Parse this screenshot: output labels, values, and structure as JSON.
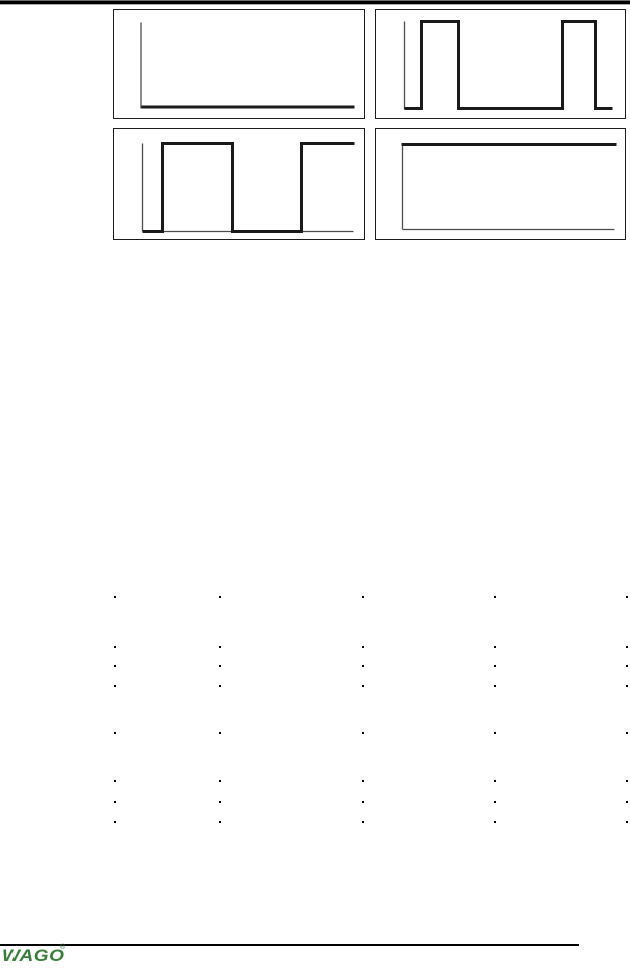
{
  "style": {
    "background": "#ffffff",
    "rule_color": "#000000",
    "box_border_color": "#1c1c1c",
    "axis_color": "#4d4d4d",
    "axis_width": 1.3,
    "signal_color": "#1a1a1a",
    "signal_width": 3,
    "logo_color": "#377e36",
    "dot_color": "#000000"
  },
  "figures": [
    {
      "name": "signal-constant-low",
      "x": 113,
      "y": 9,
      "w": 252,
      "h": 110,
      "axes": [
        {
          "x1": 28.5,
          "y1": 14,
          "x2": 28.5,
          "y2": 100
        }
      ],
      "signal": [
        [
          29,
          98.5
        ],
        [
          242,
          98.5
        ]
      ]
    },
    {
      "name": "pulse-train",
      "x": 375,
      "y": 9,
      "w": 251,
      "h": 110,
      "axes": [
        {
          "x1": 30,
          "y1": 13,
          "x2": 30,
          "y2": 101
        }
      ],
      "signal": [
        [
          30,
          100
        ],
        [
          47,
          100
        ],
        [
          47,
          13
        ],
        [
          84,
          13
        ],
        [
          84,
          100
        ],
        [
          188,
          100
        ],
        [
          188,
          13
        ],
        [
          221,
          13
        ],
        [
          221,
          100
        ],
        [
          238,
          100
        ]
      ]
    },
    {
      "name": "square-wave",
      "x": 113,
      "y": 128,
      "w": 252,
      "h": 112,
      "axes": [
        {
          "x1": 30,
          "y1": 16,
          "x2": 30,
          "y2": 104
        },
        {
          "x1": 30,
          "y1": 104,
          "x2": 241,
          "y2": 104
        }
      ],
      "signal": [
        [
          30,
          104
        ],
        [
          50,
          104
        ],
        [
          50,
          16
        ],
        [
          120,
          16
        ],
        [
          120,
          104
        ],
        [
          189,
          104
        ],
        [
          189,
          16
        ],
        [
          242,
          16
        ]
      ]
    },
    {
      "name": "signal-constant-high",
      "x": 375,
      "y": 128,
      "w": 251,
      "h": 112,
      "axes": [
        {
          "x1": 28,
          "y1": 16,
          "x2": 28,
          "y2": 102
        },
        {
          "x1": 28,
          "y1": 102,
          "x2": 240,
          "y2": 102
        }
      ],
      "signal": [
        [
          27,
          17
        ],
        [
          242,
          17
        ]
      ]
    }
  ],
  "dot_grid": {
    "columns_x": [
      114,
      219,
      362,
      494,
      626
    ],
    "rows_y": [
      596,
      646,
      665,
      685,
      732,
      780,
      801,
      821
    ],
    "dot_size": 2
  },
  "footer": {
    "logo_text": "WAGO",
    "logo_registered_mark": "®"
  }
}
